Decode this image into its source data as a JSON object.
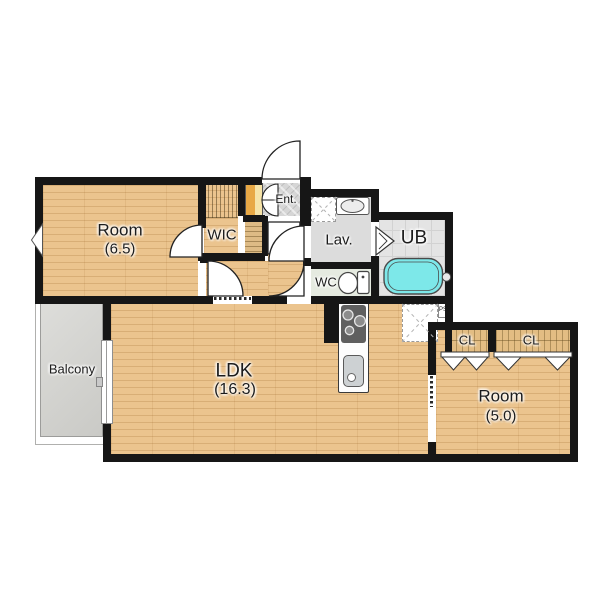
{
  "plan": {
    "rooms": {
      "room_main": {
        "label": "Room",
        "area": "(6.5)"
      },
      "wic": {
        "label": "WIC"
      },
      "entrance": {
        "label": "Ent."
      },
      "lavatory": {
        "label": "Lav."
      },
      "unit_bath": {
        "label": "UB"
      },
      "toilet_room": {
        "label": "WC"
      },
      "ldk": {
        "label": "LDK",
        "area": "(16.3)"
      },
      "balcony": {
        "label": "Balcony"
      },
      "room_second": {
        "label": "Room",
        "area": "(5.0)"
      },
      "closet_left": {
        "label": "CL"
      },
      "closet_right": {
        "label": "CL"
      },
      "pipe_space": {
        "label": "PS"
      }
    },
    "icons": {
      "bathtub": "bathtub-icon",
      "toilet": "toilet-icon",
      "wash_basin": "wash-basin-icon",
      "washer_space": "washing-machine-space-icon",
      "fridge_space": "refrigerator-space-icon",
      "stove": "gas-stove-icon",
      "kitchen_sink": "kitchen-sink-icon",
      "swing_door": "swing-door-icon",
      "sliding_door": "sliding-door-icon",
      "folding_door": "folding-closet-door-icon",
      "window": "window-icon"
    },
    "colors": {
      "wall": "#161616",
      "wood": "#ebc48e",
      "closet_wood": "#e3bd83",
      "entrance_tile": "#d6d6d6",
      "lavatory_floor": "#dcdcdc",
      "wc_floor": "#e5eae0",
      "bath_floor": "#e4e4e4",
      "bathtub": "#7de8e9",
      "balcony": "#d2d2ce",
      "shoe_cabinet": "#e8a845"
    }
  }
}
